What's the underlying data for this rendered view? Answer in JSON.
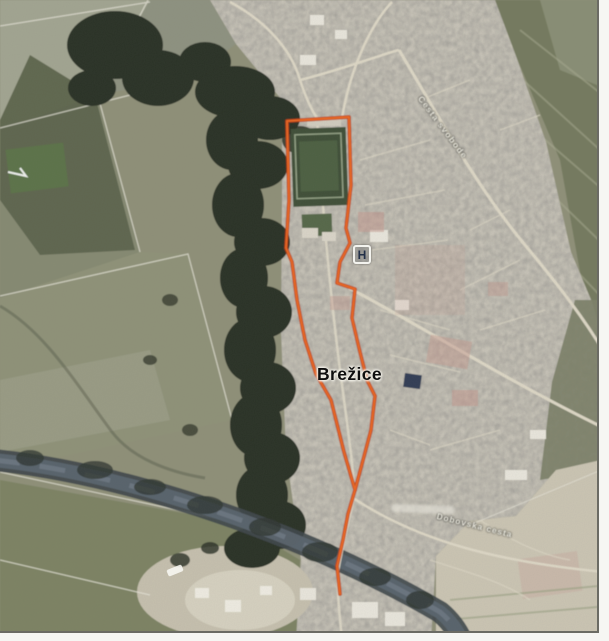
{
  "map": {
    "town_label": "Brežice",
    "hospital_marker": "H",
    "street_labels": [
      {
        "text": "Cesta svobode"
      },
      {
        "text": "Dobovska cesta"
      }
    ],
    "overlay": {
      "description": "orange site boundary overlay",
      "main_color": "#ee6722",
      "under_color": "#b93a10"
    },
    "boundary": {
      "outline": "355,490 344,452 331,400 316,374 305,340 297,300 292,262 286,248 289,200 287,121 349,117 351,185 346,228 350,243 340,262 337,283 355,289 352,318 359,348 367,380 375,396 371,430 362,464 355,490",
      "tail": "355,490 348,514 343,540 337,566 340,594"
    }
  }
}
